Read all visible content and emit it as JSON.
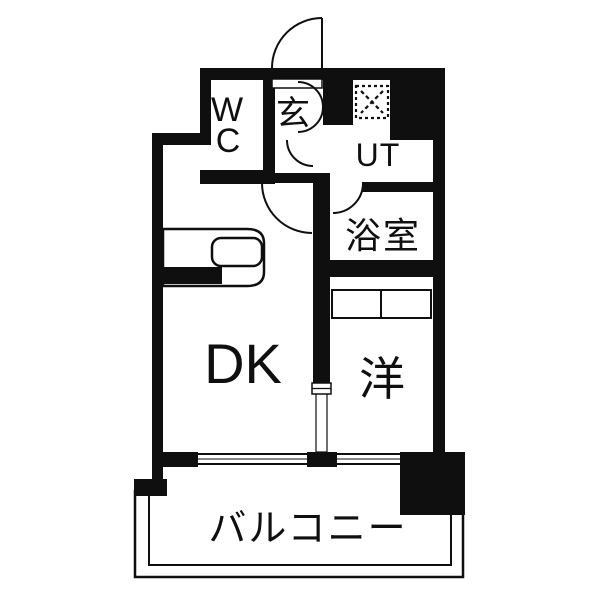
{
  "colors": {
    "wall": "#0f0f0f",
    "line": "#0f0f0f",
    "text": "#0f0f0f",
    "floor": "#ffffff"
  },
  "rooms": {
    "wc": {
      "label_lines": [
        "W",
        "C"
      ]
    },
    "entrance": {
      "label": "玄"
    },
    "utility": {
      "label": "UT"
    },
    "bathroom": {
      "label": "浴室"
    },
    "dining_kitchen": {
      "label": "DK"
    },
    "western_room": {
      "label": "洋"
    },
    "balcony": {
      "label": "バルコニー"
    }
  }
}
